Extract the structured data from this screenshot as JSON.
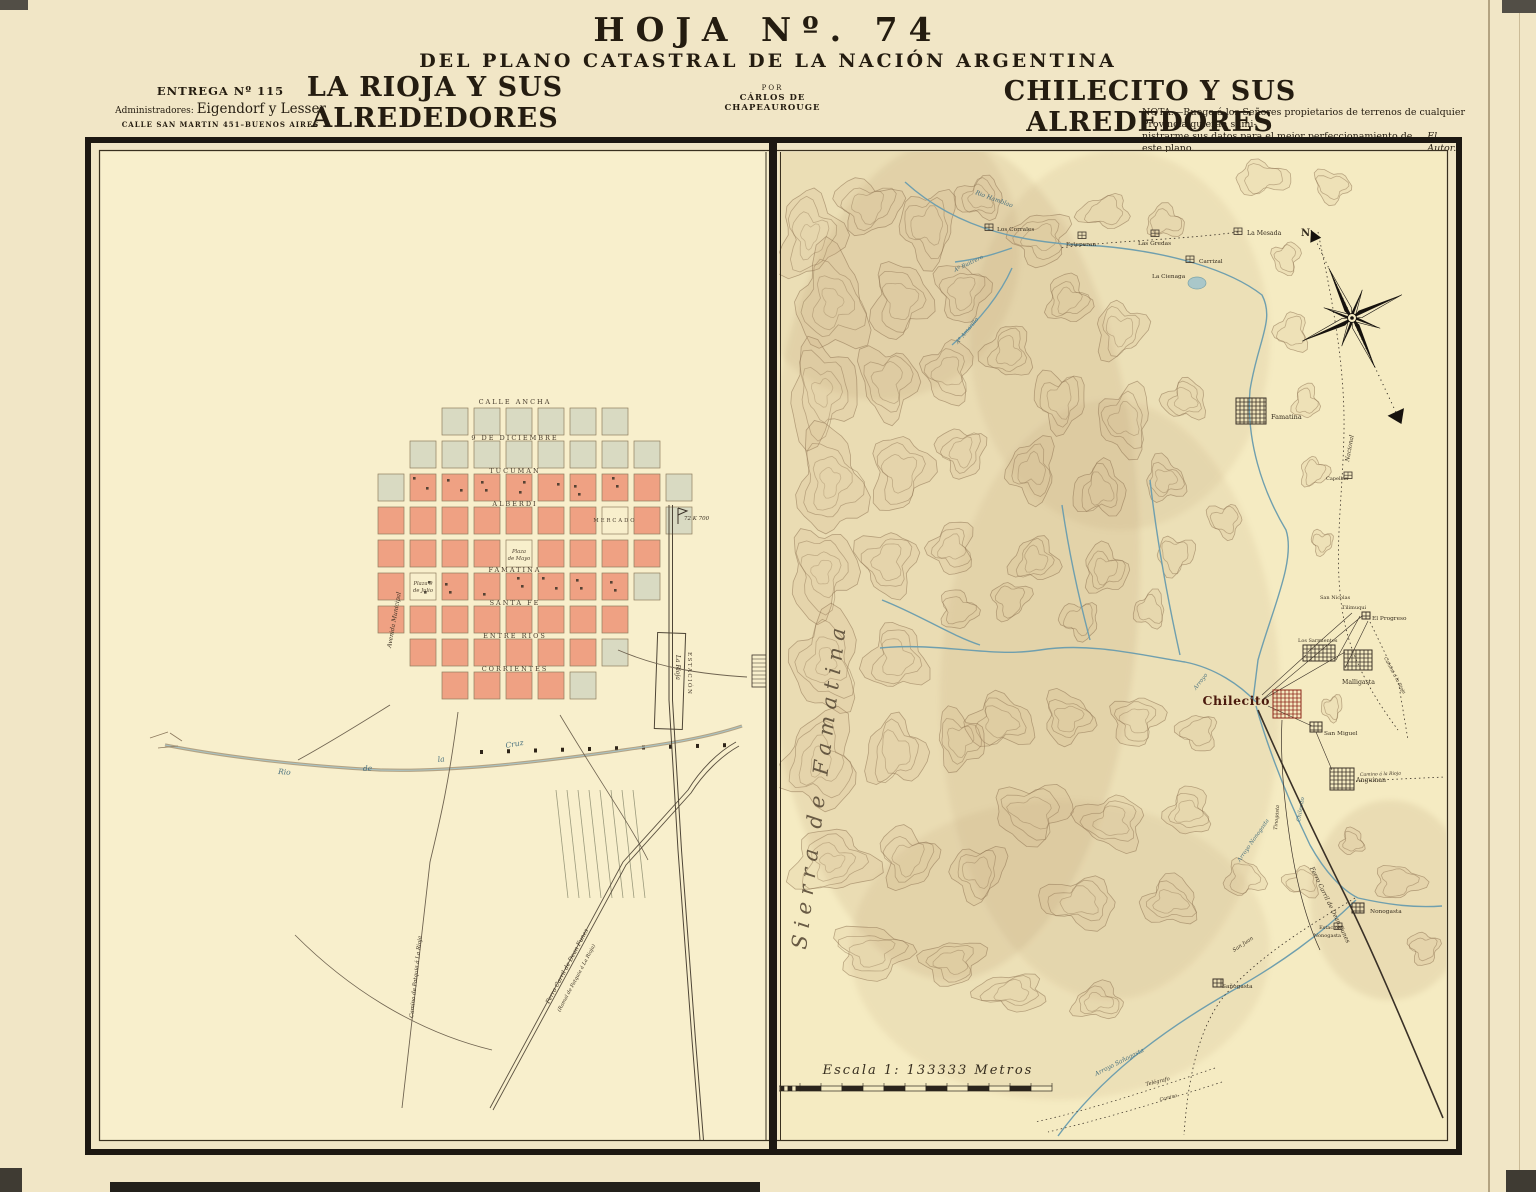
{
  "header": {
    "sheet_no": "HOJA  Nº.  74",
    "subtitle": "DEL PLANO CATASTRAL DE LA NACIÓN ARGENTINA",
    "por_label": "POR",
    "author": "CÁRLOS DE CHAPEAUROUGE",
    "entrega": "ENTREGA Nº 115",
    "admin_label": "Administradores:",
    "admin_names": "Eigendorf y Lesser",
    "address": "CALLE SAN MARTIN 451–BUENOS AIRES",
    "left_title": "LA RIOJA Y SUS ALREDEDORES",
    "right_title": "CHILECITO Y SUS ALREDEDORES",
    "nota_line1": "NOTA.—Ruego á los Señores propietarios de terrenos de cualquier Provincia quieran sumi-",
    "nota_line2": "nistrarme sus datos para el mejor perfeccionamiento de este plano.",
    "nota_signature": "El Autor."
  },
  "la_rioja": {
    "streets": [
      "Calle Ancha",
      "9 de Diciembre",
      "Tucuman",
      "Alberdi",
      "Famatina",
      "Santa Fe",
      "Entre Rios",
      "Corrientes"
    ],
    "avenue": "Avenida Municipal",
    "plaza_mayo_1": "Plaza",
    "plaza_mayo_2": "de Mayo",
    "plaza_julio_1": "Plaza 9",
    "plaza_julio_2": "de Julio",
    "mercado": "Mercado",
    "river_w1": "Rio",
    "river_w2": "de",
    "river_w3": "la",
    "river_w4": "Cruz",
    "station_1": "Estación",
    "station_2": "La Rioja",
    "km_marker": "72 K 700",
    "camino_patquia": "Camino de Patquia á La Rioja",
    "ferrocarril_1": "Ferro Carril de Dean Funes",
    "ferrocarril_2": "(Ramal de Patquia á La Rioja)"
  },
  "chilecito": {
    "sierra": "Sierra de Famatina",
    "compass_n": "N",
    "escala": "Escala 1: 133333 Metros",
    "places": {
      "la_mesada": "La Mesada",
      "los_corrales": "Los Corrales",
      "esteperan": "Esteperan",
      "las_gredas": "Las Gredas",
      "carrizal": "Carrizal",
      "la_cienaga": "La Cienaga",
      "famatina": "Famatina",
      "capellan": "Capellán",
      "san_nicolas": "San Nicolas",
      "tilimuqui": "Tilimuqui",
      "el_progreso": "El Progreso",
      "los_sarmientos": "Los Sarmientos",
      "malligasta": "Malligasta",
      "chilecito": "Chilecito",
      "san_miguel": "San Miguel",
      "anguinan": "Anguinan",
      "nonogasta": "Nonogasta",
      "estacion_1": "Estacion",
      "estacion_2": "Nonogasta",
      "sanogasta": "Sañogasta"
    },
    "rivers": {
      "rio_hamblao": "Rio Hamblao",
      "buitrero": "Aº Buitrero",
      "amarillo": "Aº Amarillo",
      "arroyo": "Arroyo",
      "rio_chilecito": "Chilecito",
      "arroyo_nonogasta": "Arroyo Nonogasta",
      "arroyo_sanogasta": "Arroyo Sañogasta"
    },
    "roads": {
      "nacional": "Nacional",
      "camino_rioja_1": "Camino á la Rioja",
      "camino_rioja_2": "Camino á la Rioja",
      "tinogasta": "Tinogasta",
      "san_juan": "San Juan",
      "telegrafo": "Telégrafo",
      "camino": "Camino",
      "ferrocarril": "Ferro Carril de Dean Funes"
    }
  }
}
